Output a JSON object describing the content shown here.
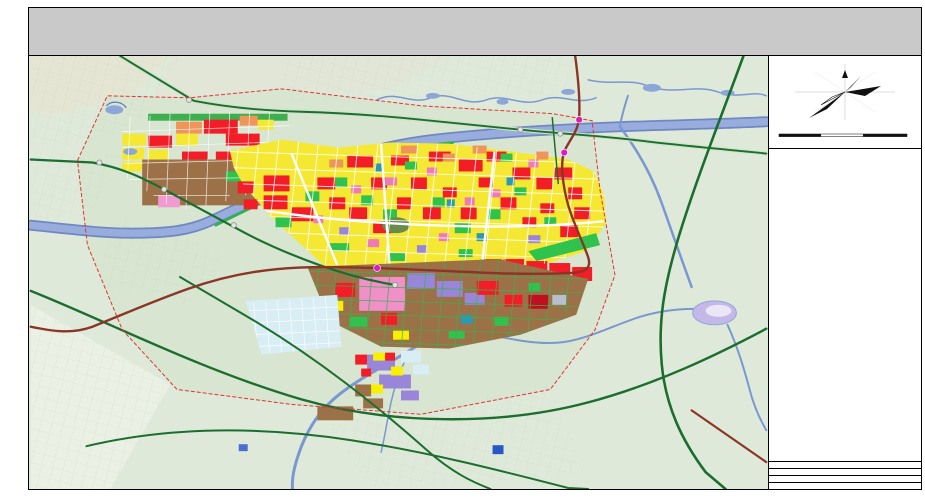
{
  "header": {
    "title": "酒泉市城市总体规划",
    "subtitle": "（2016-2030年）",
    "map_name": "用地规划图"
  },
  "map": {
    "labels": [
      {
        "text": "果园·新城墓群"
      },
      {
        "text": "金塔方向"
      },
      {
        "text": "航天方向"
      },
      {
        "text": "边湾方向"
      },
      {
        "text": "嘉峪关方向"
      },
      {
        "text": "讨赖河"
      },
      {
        "text": "北大河"
      },
      {
        "text": "总寨镇·玉门"
      },
      {
        "text": "312国道"
      },
      {
        "text": "连霍高速"
      },
      {
        "text": "酒金公路"
      }
    ],
    "colors": {
      "background": "#dfe9da",
      "residential": "#f5e832",
      "commercial": "#f21d26",
      "industrial": "#9c7148",
      "park_green": "#2fc24c",
      "water": "#8ca6d8",
      "road_green": "#1b6e2e",
      "expressway": "#8a3526",
      "boundary": "#e23333",
      "interchange_dot": "#e018c8"
    }
  },
  "panel": {
    "north_label": "N",
    "scale": {
      "t0": "0",
      "t1": "1000",
      "t2": "2000",
      "t3": "3000m"
    },
    "legend_title": "图 例",
    "s1": {
      "header": "城市建设用地（H11）",
      "col1": [
        {
          "c": "#f8f040",
          "t": "二类居住用地"
        },
        {
          "c": "#ff9090",
          "t": "教育科研用地"
        },
        {
          "c": "#f768b0",
          "t": "商住混合用地"
        },
        {
          "c": "#f21d26",
          "t": "商业用地"
        },
        {
          "c": "#ffb6cc",
          "t": "公共设施混合用地"
        },
        {
          "c": "#9c7148",
          "t": "二类工业用地"
        },
        {
          "c": "#9aa0b8",
          "t": "交通枢纽用地"
        },
        {
          "c": "#bcc4da",
          "t": "社会停车场用地"
        },
        {
          "c": "#39b54a",
          "t": "防护绿地"
        },
        {
          "c": "#3ddc66",
          "t": "公园绿地"
        }
      ],
      "col2": [
        {
          "c": "#f8734e",
          "t": "行政办公用地"
        },
        {
          "c": "#109fa8",
          "t": "体育用地"
        },
        {
          "c": "#ff8c3e",
          "t": "文化设施用地"
        },
        {
          "c": "#f04858",
          "t": "医疗卫生用地"
        },
        {
          "c": "#ff9a6e",
          "t": "商务设施用地"
        },
        {
          "c": "#9a86d8",
          "t": "物流仓储用地"
        },
        {
          "c": "#4a88d8",
          "t": "公用设施用地"
        },
        {
          "c": "#ffa24e",
          "t": "供应设施用地"
        },
        {
          "c": "#2ab0a0",
          "t": "环境设施用地"
        },
        {
          "c": "#dcdcec",
          "t": "广场用地"
        }
      ],
      "col3": [
        {
          "c": "#ffa0c8",
          "t": "中小学用地"
        },
        {
          "c": "#f05868",
          "t": "社会福利用地"
        },
        {
          "c": "#ffb49e",
          "t": "宗教设施用地"
        },
        {
          "c": "#c89a6a",
          "t": "一类工业用地"
        },
        {
          "c": "#b49ae2",
          "t": "仓储用地"
        },
        {
          "c": "#ff86b4",
          "t": "娱乐康体用地"
        },
        {
          "c": "#f0a048",
          "t": "供燃气用地"
        },
        {
          "c": "#2890c8",
          "t": "排水设施用地"
        },
        {
          "c": "#e85038",
          "t": "消防设施用地"
        },
        {
          "c": "#20c050",
          "t": "街头绿地"
        }
      ]
    },
    "s2": {
      "header": "区域建设用地",
      "items": [
        {
          "c": "#c9cdd9",
          "t": "区域交通设施用地"
        },
        {
          "c": "#2878c8",
          "t": "区域公用设施用地"
        },
        {
          "c": "#4a7a3c",
          "t": "特殊用地"
        }
      ]
    },
    "s3": {
      "header": "水域及其他用地",
      "items": [
        {
          "c": "#8fa8d8",
          "t": "水域"
        },
        {
          "c": "#cfe6c8",
          "t": "农林用地"
        },
        {
          "c": "#e8f4ee",
          "t": "其他非建设用地"
        }
      ]
    },
    "s4": {
      "header": "设施图例",
      "col1": [
        {
          "k": "客",
          "t": "长途客运站"
        },
        {
          "k": "公",
          "t": "公交首末站"
        },
        {
          "k": "油",
          "t": "加油加气站"
        },
        {
          "k": "热",
          "t": "供热站"
        },
        {
          "k": "变",
          "t": "变电站"
        },
        {
          "k": "污",
          "t": "污水处理厂"
        },
        {
          "k": "医",
          "t": "医院"
        },
        {
          "k": "中",
          "t": "中学"
        }
      ],
      "col2": [
        {
          "k": "停",
          "t": "社会停车场"
        },
        {
          "k": "邮",
          "t": "邮政局"
        },
        {
          "k": "气",
          "t": "燃气门站"
        },
        {
          "k": "水",
          "t": "给水厂"
        },
        {
          "k": "消",
          "t": "消防站"
        },
        {
          "k": "垃",
          "t": "垃圾转运站"
        },
        {
          "k": "文",
          "t": "文化中心"
        },
        {
          "k": "小",
          "t": "小学"
        }
      ],
      "col3": [
        {
          "k": "广",
          "t": "广场"
        },
        {
          "k": "体",
          "t": "体育中心"
        },
        {
          "k": "福",
          "t": "社会福利院"
        },
        {
          "k": "环",
          "t": "环卫设施"
        },
        {
          "k": "市",
          "t": "农贸市场"
        },
        {
          "k": "幼",
          "t": "幼儿园"
        },
        {
          "k": "警",
          "t": "派出所"
        },
        {
          "k": "社",
          "t": "社区中心"
        }
      ]
    },
    "s5": {
      "header": "道路与界线",
      "items": [
        {
          "g": "g-ic",
          "t": "互通式立交"
        },
        {
          "g": "g-exit",
          "t": "高速出入口"
        },
        {
          "g": "g-hs",
          "t": "高速公路"
        },
        {
          "g": "g-exp",
          "t": "快速路"
        },
        {
          "g": "g-rd",
          "t": "公路"
        },
        {
          "g": "g-wp",
          "t": "水源地一级保护区"
        },
        {
          "g": "g-gb",
          "t": "生态防护绿带"
        },
        {
          "g": "g-cor",
          "t": "基础设施廊道"
        },
        {
          "g": "g-adm",
          "t": "行政区划界线"
        },
        {
          "g": "g-cb",
          "t": "中心城区规划边界"
        },
        {
          "g": "g-rb",
          "t": "远景储备用地界线"
        },
        {
          "g": "g-hv",
          "t": "高压线走廊"
        }
      ]
    },
    "sheet_no": "NO. 2—15",
    "authority": "酒泉市人民政府",
    "institute": "甘肃省城乡规划设计研究院"
  }
}
